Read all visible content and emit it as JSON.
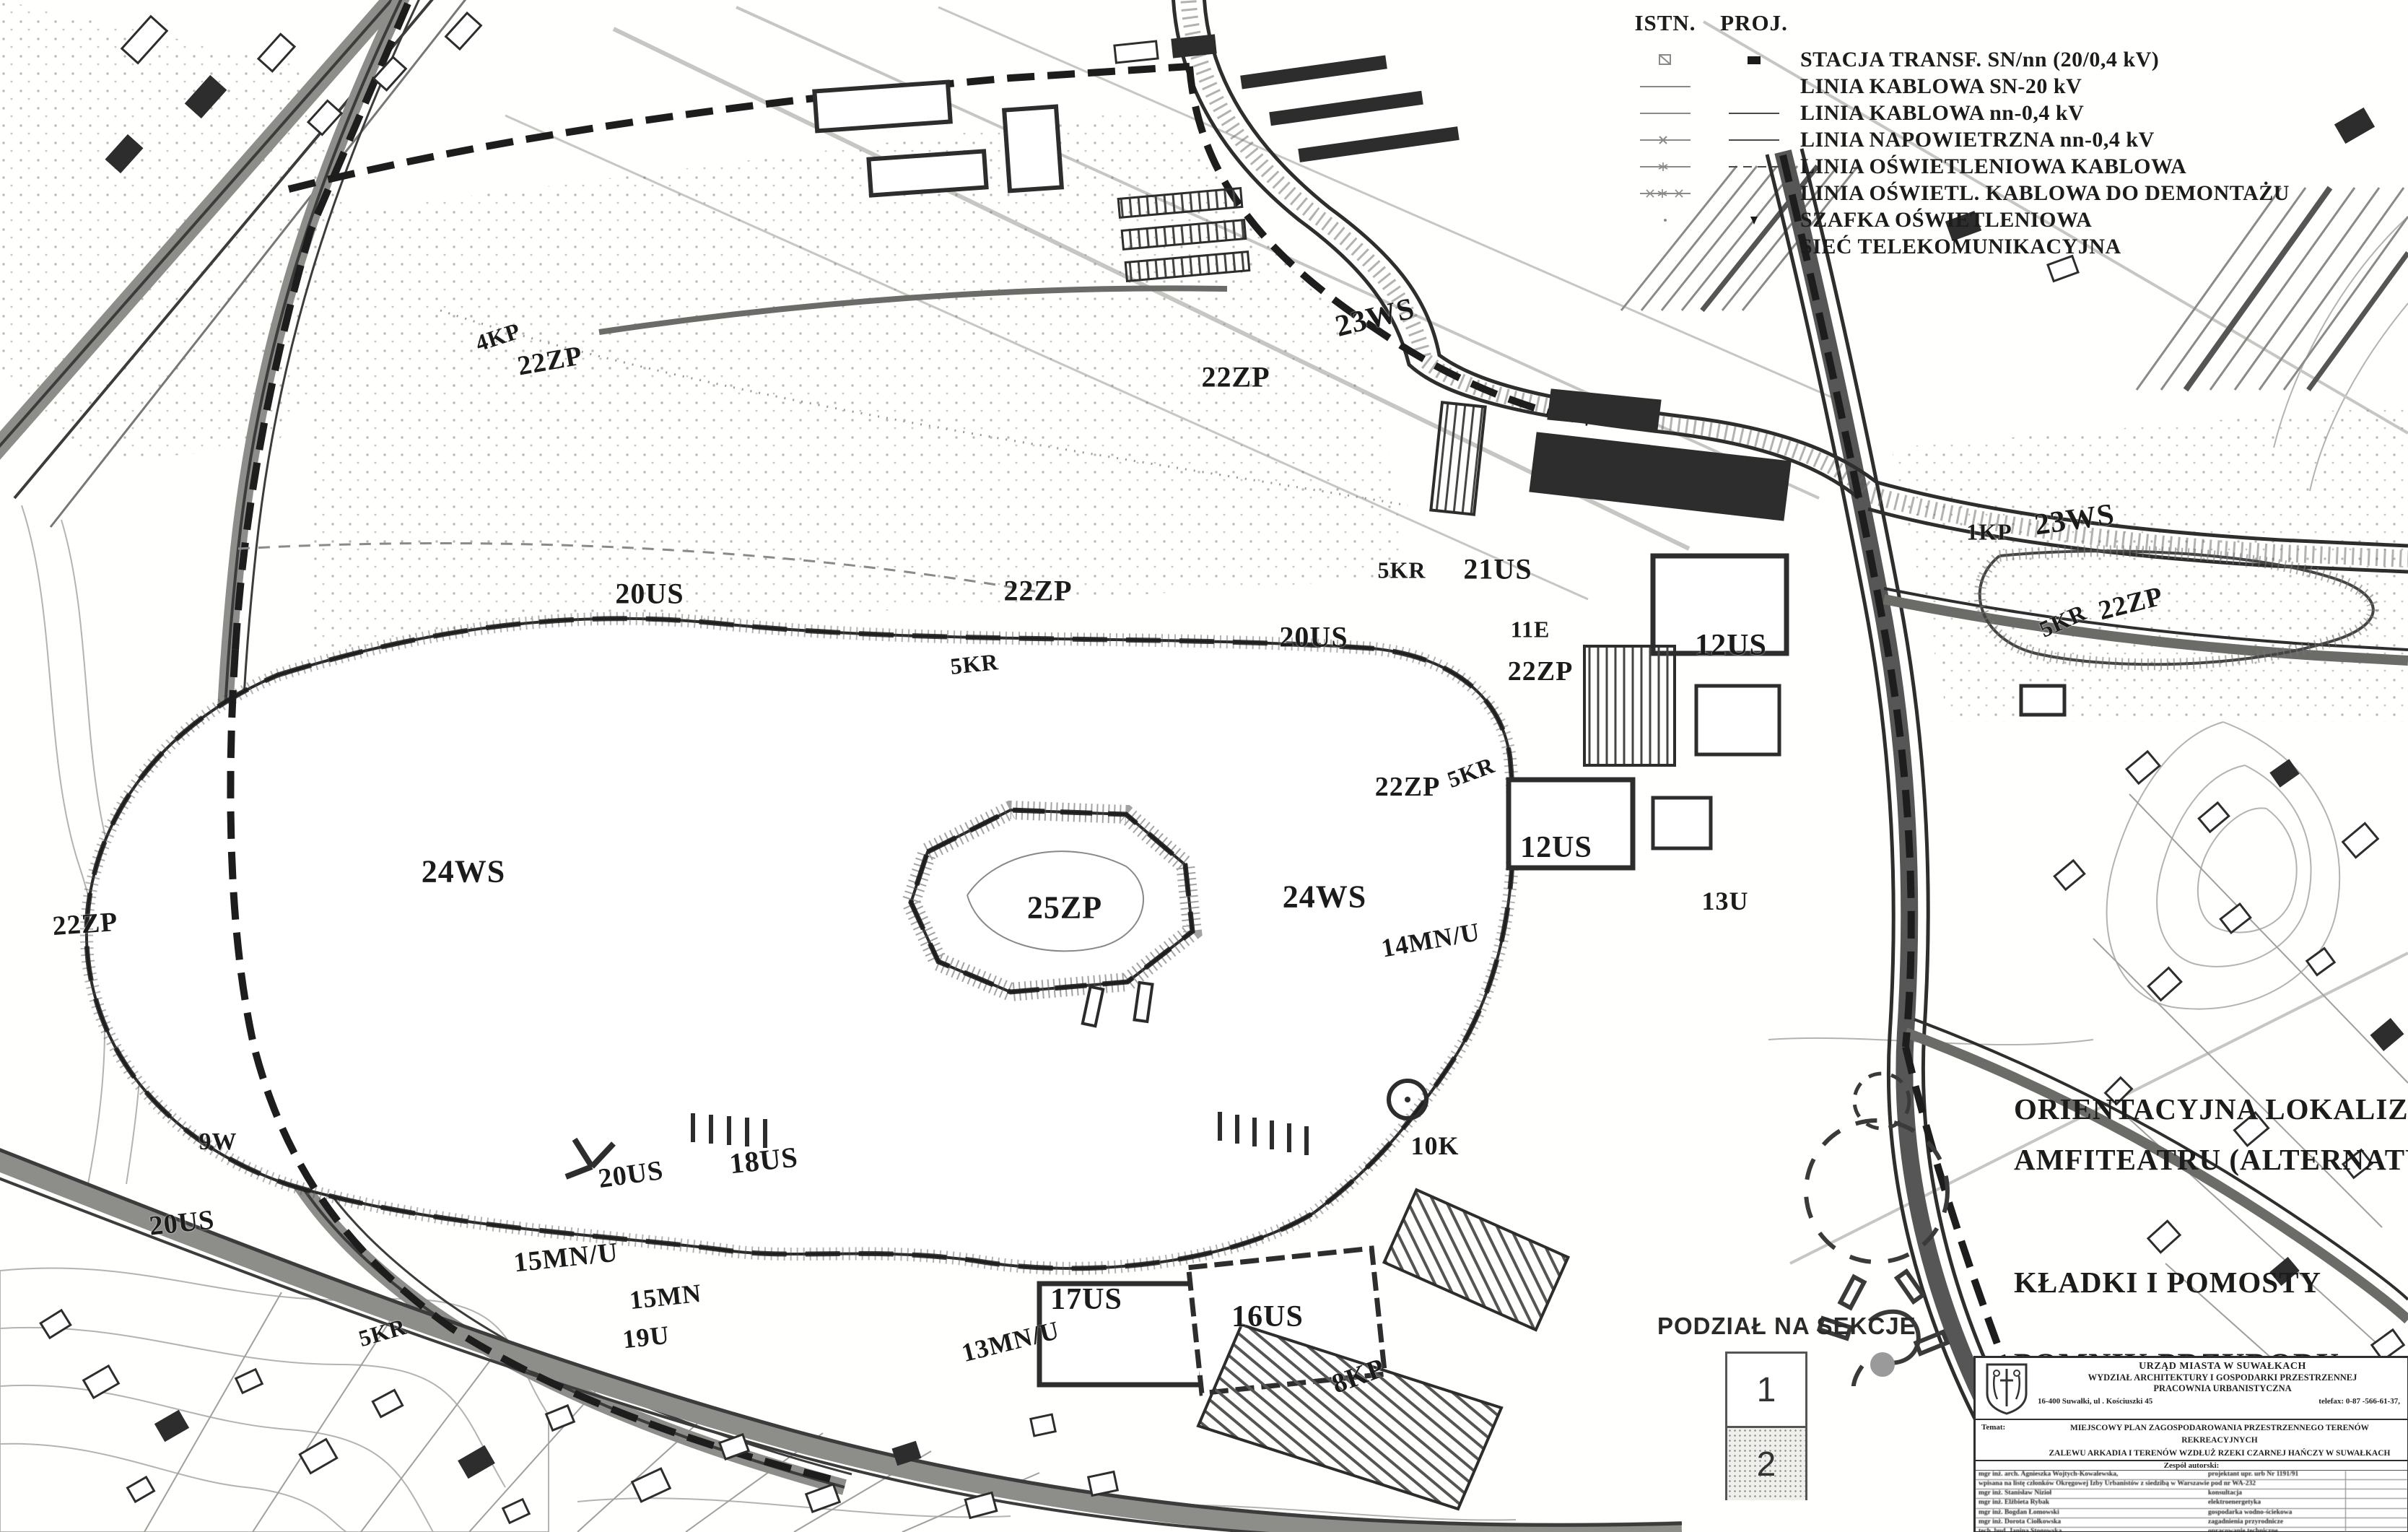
{
  "colors": {
    "ink": "#1b1b1b",
    "road_gray": "#555555",
    "light_gray": "#bbbbbb",
    "monument_gray": "#9a9a9a",
    "paper": "#fffffd"
  },
  "legend": {
    "col_istn": "ISTN.",
    "col_proj": "PROJ.",
    "items": [
      "STACJA TRANSF. SN/nn (20/0,4 kV)",
      "LINIA KABLOWA SN-20 kV",
      "LINIA KABLOWA nn-0,4 kV",
      "LINIA NAPOWIETRZNA nn-0,4 kV",
      "LINIA OŚWIETLENIOWA KABLOWA",
      "LINIA OŚWIETL. KABLOWA DO DEMONTAŻU",
      "SZAFKA OŚWIETLENIOWA",
      "SIEĆ TELEKOMUNIKACYJNA"
    ]
  },
  "legend2": {
    "amphitheater_line1": "ORIENTACYJNA LOKALIZACJA",
    "amphitheater_line2": "AMFITEATRU (ALTERNATYWA)",
    "bridges": "KŁADKI I POMOSTY",
    "monument": "POMNIK PRZYRODY"
  },
  "sections": {
    "title": "PODZIAŁ NA SEKCJE",
    "section1": "1",
    "section2": "2"
  },
  "map": {
    "labels": [
      "4KP",
      "22ZP",
      "23WS",
      "22ZP",
      "20US",
      "22ZP",
      "5KR",
      "20US",
      "5KR",
      "21US",
      "11E",
      "22ZP",
      "12US",
      "5KR",
      "22ZP",
      "12US",
      "13U",
      "24WS",
      "25ZP",
      "24WS",
      "22ZP",
      "14MN/U",
      "9W",
      "20US",
      "5KR",
      "18US",
      "20US",
      "15MN/U",
      "15MN",
      "19U",
      "17US",
      "16US",
      "8KP",
      "10K",
      "13MN/U",
      "23WS",
      "22ZP",
      "5KR",
      "1KP"
    ]
  },
  "titleblock": {
    "office_line1": "URZĄD MIASTA W SUWAŁKACH",
    "office_line2": "WYDZIAŁ ARCHITEKTURY I GOSPODARKI PRZESTRZENNEJ",
    "office_line3": "PRACOWNIA URBANISTYCZNA",
    "address": "16-400 Suwałki, ul . Kościuszki 45",
    "telefax": "telefax: 0-87 -566-61-37,",
    "temat_label": "Temat:",
    "temat_line1": "MIEJSCOWY PLAN ZAGOSPODAROWANIA PRZESTRZENNEGO TERENÓW REKREACYJNYCH",
    "temat_line2": "ZALEWU ARKADIA I TERENÓW WZDŁUŻ RZEKI CZARNEJ HAŃCZY W SUWAŁKACH",
    "team_header": "Zespół autorski:",
    "authors": [
      {
        "name": "mgr inż. arch. Agnieszka Wojtych-Kowalewska,",
        "role": "projektant   upr. urb Nr 1191/91"
      },
      {
        "name": "wpisana na listę członków Okręgowej Izby Urbanistów z siedzibą w Warszawie pod nr WA-232",
        "role": ""
      },
      {
        "name": "mgr inż.  Stanisław Nizioł",
        "role": "konsultacja"
      },
      {
        "name": "mgr inż.  Elżbieta Rybak",
        "role": "elektroenergetyka"
      },
      {
        "name": "mgr inż. Bogdan Łomowski",
        "role": "gospodarka wodno-ściekowa"
      },
      {
        "name": "mgr inż. Dorota Ciołkowska",
        "role": "zagadnienia przyrodnicze"
      },
      {
        "name": "tech. bud.  Janina Stogowska",
        "role": "opracowanie techniczne"
      },
      {
        "name": "tech. bud.  Danuta Zawadzka",
        "role": "opracowanie techniczne"
      },
      {
        "name": "tech. inf.  Adam Tymkowski",
        "role": "opracowanie komputerowe"
      }
    ]
  }
}
